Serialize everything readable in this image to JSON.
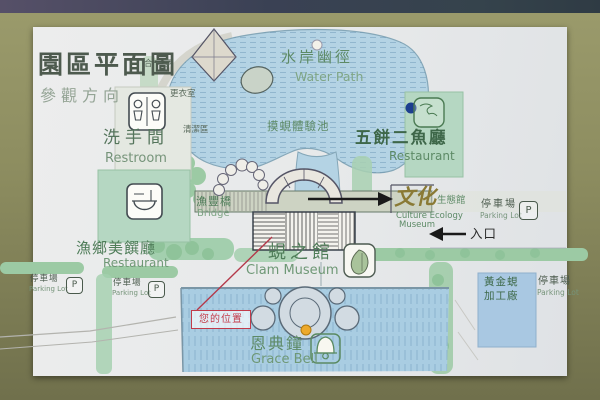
{
  "sign": {
    "title": "園區平面圖",
    "subtitle": "參觀方向"
  },
  "locations": {
    "water_path": {
      "zh": "水岸幽徑",
      "en": "Water Path"
    },
    "unity_pavilion": {
      "zh": "合一亭"
    },
    "changing_room": {
      "zh": "更衣室"
    },
    "cleaning_area": {
      "zh": "清潔區"
    },
    "restroom": {
      "zh": "洗手間",
      "en": "Restroom"
    },
    "clam_touch_pool": {
      "zh": "摸蜆體驗池"
    },
    "fish_restaurant": {
      "zh": "五餅二魚廳",
      "en": "Restaurant"
    },
    "bridge": {
      "zh": "漁豐橋",
      "en": "Bridge"
    },
    "culture_museum": {
      "zh_calligraphy": "文化",
      "zh_small": "生態館",
      "en1": "Culture Ecology",
      "en2": "Museum"
    },
    "entrance": {
      "zh": "入口"
    },
    "clam_museum": {
      "zh": "蜆之館",
      "en": "Clam Museum"
    },
    "your_location": {
      "zh": "您的位置"
    },
    "grace_bell": {
      "zh": "恩典鐘",
      "en": "Grace Bell"
    },
    "local_restaurant": {
      "zh": "漁鄉美饌廳",
      "en": "Restaurant"
    },
    "parking": {
      "zh": "停車場",
      "en": "Parking Lot"
    },
    "processing_plant": {
      "zh1": "黃金蜆",
      "zh2": "加工廠"
    }
  },
  "icons": {
    "parking_glyph": "P",
    "restroom_icon": "restroom-figures-icon",
    "bowl_icon": "rice-bowl-icon",
    "bell_icon": "bell-icon",
    "clam_icon": "clam-shell-icon",
    "stamp_icon": "restaurant-seal-icon"
  },
  "markers": {
    "you_are_here_color": "#c23b4a",
    "bell_dot_color": "#eda92b",
    "restaurant_dot_color": "#1d3f8f",
    "pond_dot_color": "#f3f1e9"
  },
  "colors": {
    "frame": "#8d8d60",
    "paper": "#e9eaea",
    "water": "#aecfe2",
    "vegetation": "#9ccaa4",
    "building_green": "#b5d7c2",
    "label_green": "#55755c",
    "title_green": "#4d5a4e",
    "calligraphy_brown": "#8a7a35"
  }
}
